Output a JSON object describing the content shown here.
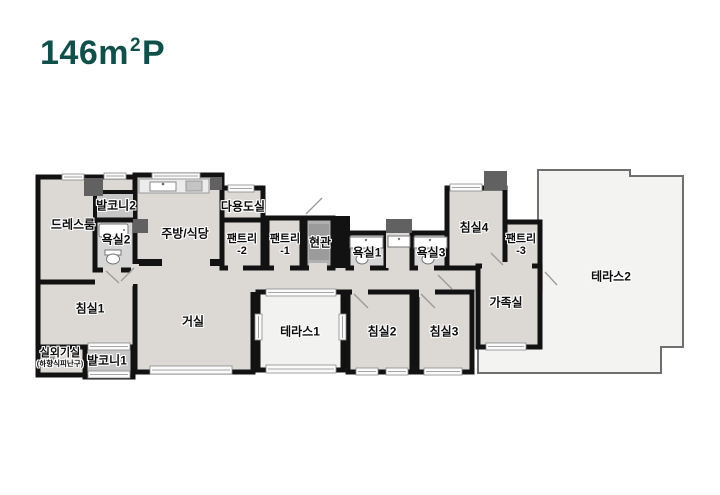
{
  "title": {
    "area_value": "146m",
    "area_sup": "2",
    "type_suffix": "P"
  },
  "colors": {
    "title_text": "#11504a",
    "wall": "#121212",
    "room_floor": "#dcd8d3",
    "terrace_floor": "#f3f3f1",
    "balcony_floor": "#c6c6c6",
    "bath_floor": "#d6d6d6",
    "entrance_floor": "#b0b0b0"
  },
  "rooms": {
    "dressroom": {
      "label": "드레스룸"
    },
    "balcony2": {
      "label": "발코니2"
    },
    "bath2": {
      "label": "욕실2"
    },
    "kitchen_dining": {
      "label": "주방/식당"
    },
    "utility": {
      "label": "다용도실"
    },
    "pantry2": {
      "label": "팬트리",
      "label2": "-2"
    },
    "pantry1": {
      "label": "팬트리",
      "label2": "-1"
    },
    "entrance": {
      "label": "현관"
    },
    "bath1": {
      "label": "욕실1"
    },
    "bath3": {
      "label": "욕실3"
    },
    "bedroom4": {
      "label": "침실4"
    },
    "pantry3": {
      "label": "팬트리",
      "label2": "-3"
    },
    "terrace2": {
      "label": "테라스2"
    },
    "bedroom1": {
      "label": "침실1"
    },
    "outdoor_unit": {
      "label": "실외기실",
      "label2": "(하향식피난구)"
    },
    "balcony1": {
      "label": "발코니1"
    },
    "living": {
      "label": "거실"
    },
    "terrace1": {
      "label": "테라스1"
    },
    "bedroom2": {
      "label": "침실2"
    },
    "bedroom3": {
      "label": "침실3"
    },
    "family": {
      "label": "가족실"
    }
  }
}
